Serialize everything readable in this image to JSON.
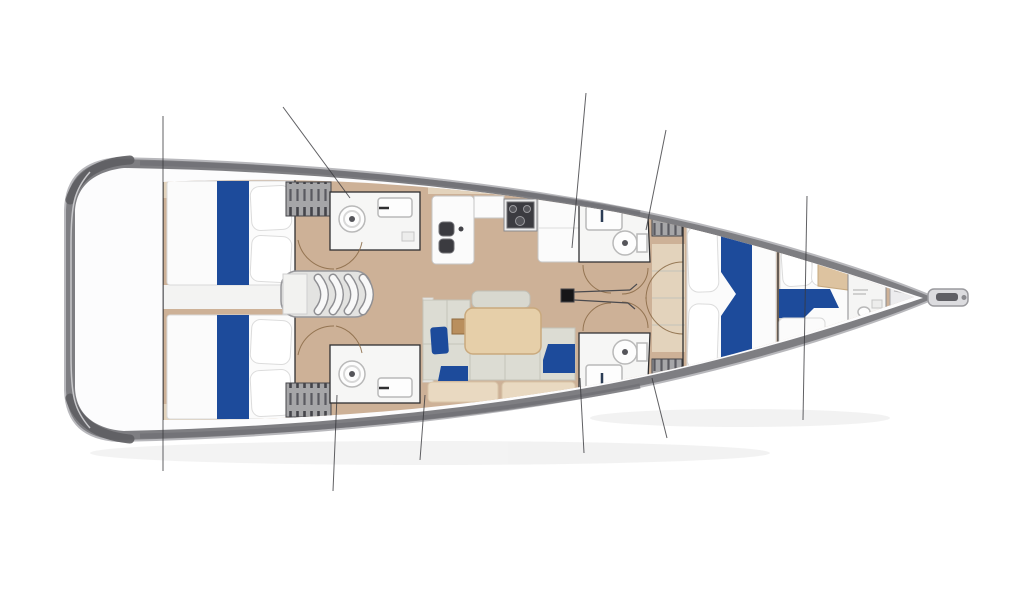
{
  "canvas": {
    "width": 1024,
    "height": 600
  },
  "palette": {
    "background": "#ffffff",
    "hull_band": "#7e7e82",
    "hull_band_dark": "#5e5e62",
    "hull_edge_light": "#b8b8bc",
    "deck_white": "#fcfcfd",
    "floor_wood": "#cdb197",
    "floor_wood_light": "#e3d3bc",
    "mattress_white": "#fbfbfb",
    "accent_blue": "#1d4b9b",
    "sofa_gray": "#dcdcd3",
    "table_tan": "#e6cfa9",
    "locker_gray": "#a6a6a8",
    "appliance_dark": "#3b3b40",
    "wall_dark": "#2e2e30",
    "door_arc": "#8a6a45",
    "rig_line": "#39393d"
  },
  "rigging_lines": [
    {
      "x1": 163,
      "y1": 116,
      "x2": 163,
      "y2": 471
    },
    {
      "x1": 283,
      "y1": 107,
      "x2": 350,
      "y2": 198
    },
    {
      "x1": 586,
      "y1": 93,
      "x2": 572,
      "y2": 248
    },
    {
      "x1": 666,
      "y1": 130,
      "x2": 646,
      "y2": 230
    },
    {
      "x1": 807,
      "y1": 196,
      "x2": 803,
      "y2": 420
    },
    {
      "x1": 580,
      "y1": 378,
      "x2": 584,
      "y2": 453
    },
    {
      "x1": 652,
      "y1": 378,
      "x2": 667,
      "y2": 438
    },
    {
      "x1": 337,
      "y1": 395,
      "x2": 333,
      "y2": 491
    },
    {
      "x1": 425,
      "y1": 395,
      "x2": 420,
      "y2": 460
    }
  ],
  "mast": {
    "x": 561,
    "y": 289,
    "size": 13
  },
  "companionway": {
    "tread_x": [
      318,
      333,
      348,
      363
    ],
    "y_top": 278,
    "y_bottom": 311,
    "bulge": 13
  },
  "inventory": {
    "aft_cabins": 2,
    "mid_heads": 2,
    "forward_heads": 2,
    "owner_cabin": 1,
    "bow_cabin": 1,
    "bow_head": 1,
    "companionway_treads": 4
  }
}
